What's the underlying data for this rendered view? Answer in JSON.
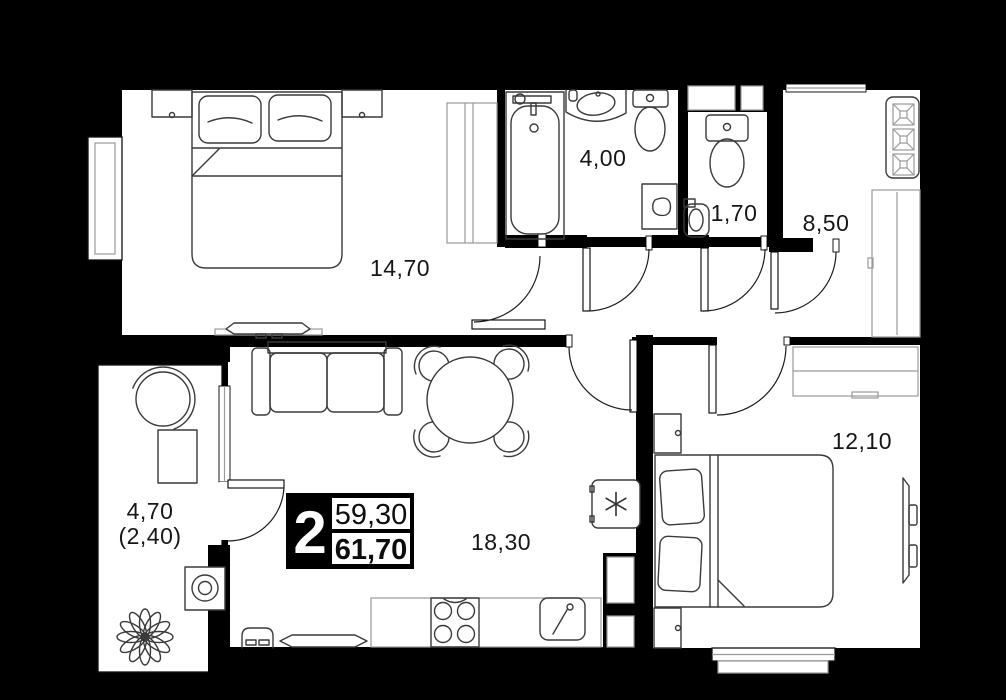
{
  "plan": {
    "title": "2-room apartment floor plan",
    "info_block": {
      "room_count": "2",
      "living_area": "59,30",
      "total_area": "61,70"
    },
    "rooms": [
      {
        "id": "bedroom-1",
        "area": "14,70"
      },
      {
        "id": "bathroom",
        "area": "4,00"
      },
      {
        "id": "wc",
        "area": "1,70"
      },
      {
        "id": "kitchen",
        "area": "8,50"
      },
      {
        "id": "bedroom-2",
        "area": "12,10"
      },
      {
        "id": "living-room",
        "area": "18,30"
      },
      {
        "id": "balcony",
        "area": "4,70",
        "area_secondary": "(2,40)"
      }
    ],
    "colors": {
      "background": "#000000",
      "floor": "#ffffff",
      "line": "#1c1c1c"
    }
  }
}
